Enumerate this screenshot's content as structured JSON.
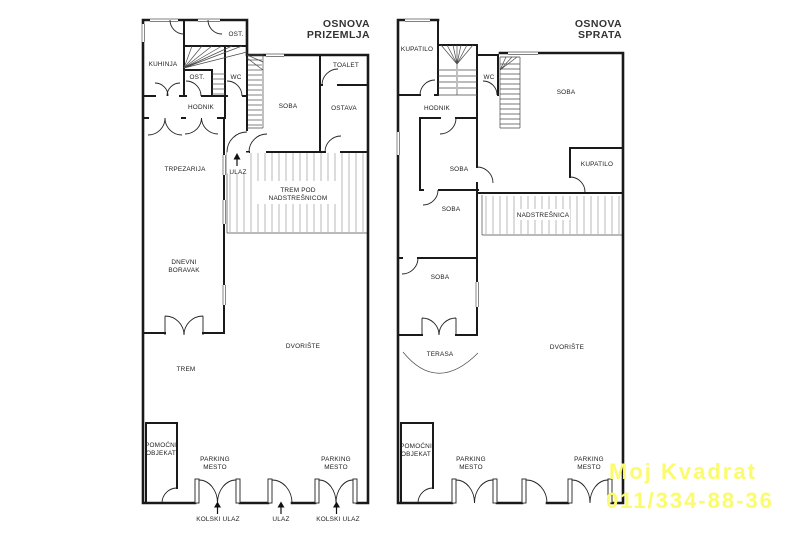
{
  "colors": {
    "wall": "#1a1a1a",
    "watermark": "#FBFB6E"
  },
  "watermark": {
    "line1": "Moj Kvadrat",
    "line2": "011/334-88-36"
  },
  "plans": {
    "ground": {
      "title_line1": "OSNOVA",
      "title_line2": "PRIZEMLJA",
      "rooms": {
        "kuhinja": "KUHINJA",
        "ost_top": "OST.",
        "ost": "OST.",
        "wc": "WC",
        "hodnik": "HODNIK",
        "soba": "SOBA",
        "toalet": "TOALET",
        "ostava": "OSTAVA",
        "trpezarija": "TRPEZARIJA",
        "ulaz": "ULAZ",
        "trem_pod_l1": "TREM POD",
        "trem_pod_l2": "NADSTREŠNICOM",
        "dnevni_l1": "DNEVNI",
        "dnevni_l2": "BORAVAK",
        "trem": "TREM",
        "dvoriste": "DVORIŠTE",
        "pomocni_l1": "POMOĆNI",
        "pomocni_l2": "OBJEKAT",
        "parking1_l1": "PARKING",
        "parking1_l2": "MESTO",
        "parking2_l1": "PARKING",
        "parking2_l2": "MESTO",
        "kolski_ulaz_left": "KOLSKI ULAZ",
        "ulaz_gate": "ULAZ",
        "kolski_ulaz_right": "KOLSKI ULAZ"
      }
    },
    "upper": {
      "title_line1": "OSNOVA",
      "title_line2": "SPRATA",
      "rooms": {
        "kupatilo_top": "KUPATILO",
        "wc": "WC",
        "hodnik": "HODNIK",
        "soba_big": "SOBA",
        "kupatilo_right": "KUPATILO",
        "soba1": "SOBA",
        "soba2": "SOBA",
        "soba3": "SOBA",
        "nadstresnica": "NADSTREŠNICA",
        "terasa": "TERASA",
        "dvoriste": "DVORIŠTE",
        "pomocni_l1": "POMOĆNI",
        "pomocni_l2": "OBJEKAT",
        "parking1_l1": "PARKING",
        "parking1_l2": "MESTO",
        "parking2_l1": "PARKING",
        "parking2_l2": "MESTO"
      }
    }
  }
}
